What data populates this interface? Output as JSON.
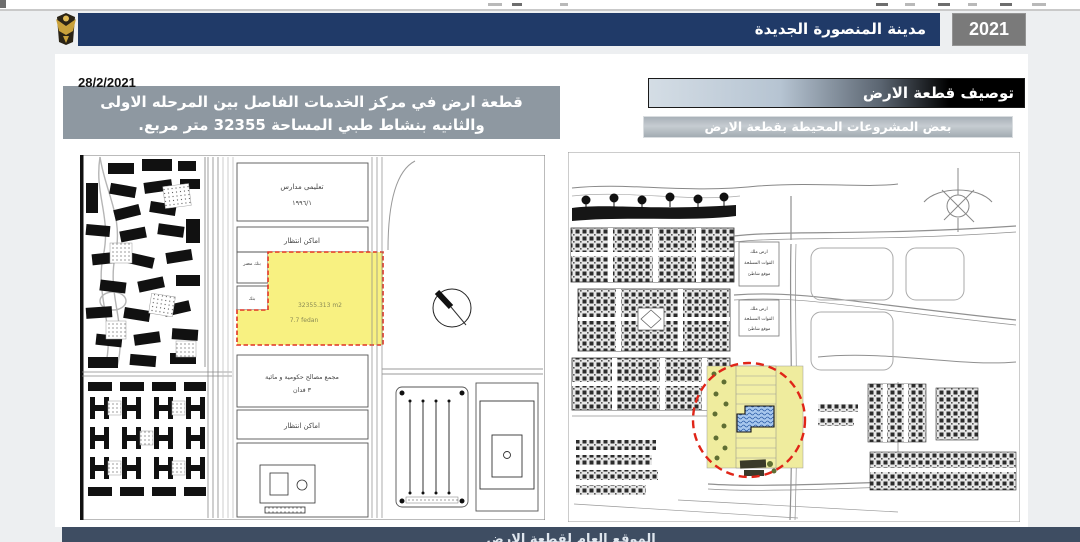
{
  "header": {
    "year": "2021",
    "title": "مدينة المنصورة الجديدة",
    "logo": "egypt-eagle-emblem"
  },
  "description": {
    "date": "28/2/2021",
    "line1": "قطعة ارض في مركز الخدمات الفاصل بين المرحله الاولى",
    "line2": "والثانيه بنشاط طبي المساحة  32355 متر مربع."
  },
  "sections": {
    "plot_description_title": "توصيف قطعة الارض",
    "surrounding_projects_title": "بعض المشروعات المحيطة بقطعة الارض"
  },
  "left_map": {
    "labels": {
      "schools": "تعليمى مدارس",
      "schools_ref": "١٩٩٦/١",
      "parking_upper": "اماكن انتظار",
      "bank_misr": "بنك مصر",
      "bank": "بنك",
      "plot_area_m2": "32355.313 m2",
      "plot_area_feddan": "7.7 fedan",
      "government_complex": "مجمع مصالح حكومية و مائية",
      "government_feddan": "٣ فدان",
      "parking_lower": "اماكن انتظار"
    }
  },
  "right_map": {
    "labels": {
      "army_plot_1": {
        "l1": "ارض ملك",
        "l2": "القوات المسلحة",
        "l3": "موقع شاطئ"
      },
      "army_plot_2": {
        "l1": "ارض ملك",
        "l2": "القوات المسلحة",
        "l3": "موقع شاطئ"
      }
    }
  },
  "footer": {
    "title_partial": "الموقع العام لقطعة الارض"
  },
  "colors": {
    "header_navy": "#203A68",
    "year_box_gray": "#7A7A7A",
    "description_box_gray": "#8E98A1",
    "title_box_black": "#000000",
    "subtitle_box_gray": "#AEB7BE",
    "footer_bar": "#3E4D62",
    "plot_highlight_yellow": "#F8F181",
    "highlight_dashed_red": "#E02518",
    "building_blue": "#9CC0EA"
  }
}
